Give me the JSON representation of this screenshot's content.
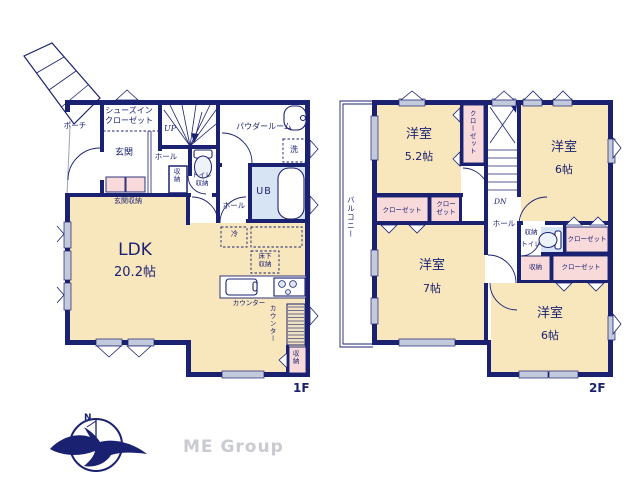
{
  "colors": {
    "wall_navy": "#1b2171",
    "room_cream": "#f8e6bd",
    "closet_pink": "#f8dada",
    "bath_blue": "#d6e4f3",
    "window_gray": "#c3cadb",
    "logo_gray": "#c9cbd0"
  },
  "floor1": {
    "floor_tag": "1F",
    "rooms": {
      "porch": "ポーチ",
      "shoes_in_closet": "シューズイン\nクローゼット",
      "entrance": "玄関",
      "hall_upper": "ホール",
      "stairs_up": "UP",
      "hall_storage": "収納",
      "toilet_storage": "トイレ\n収納",
      "powder_room": "パウダールーム",
      "laundry": "洗",
      "unit_bath": "UB",
      "hall_lower": "ホール",
      "entrance_storage": "玄関収納",
      "ldk_name": "LDK",
      "ldk_size": "20.2帖",
      "refrigerator": "冷",
      "underfloor_storage": "床下\n収納",
      "kitchen_counter": "カウンター",
      "side_counter": "カウンター",
      "corner_storage": "収納"
    }
  },
  "floor2": {
    "floor_tag": "2F",
    "rooms": {
      "balcony": "バルコニー",
      "western_room_52_name": "洋室",
      "western_room_52_size": "5.2帖",
      "closet_stairside": "クローゼット",
      "stairs_dn": "DN",
      "western_room_6u_name": "洋室",
      "western_room_6u_size": "6帖",
      "closet_a": "クローゼット",
      "closet_b": "クロー\nゼット",
      "hall": "ホール",
      "storage_a": "収納",
      "toilet": "トイレ",
      "closet_c": "クローゼット",
      "storage_b": "収納",
      "closet_d": "クローゼット",
      "western_room_7_name": "洋室",
      "western_room_7_size": "7帖",
      "western_room_6l_name": "洋室",
      "western_room_6l_size": "6帖"
    }
  },
  "logo": {
    "north": "N",
    "company": "ME Group"
  }
}
